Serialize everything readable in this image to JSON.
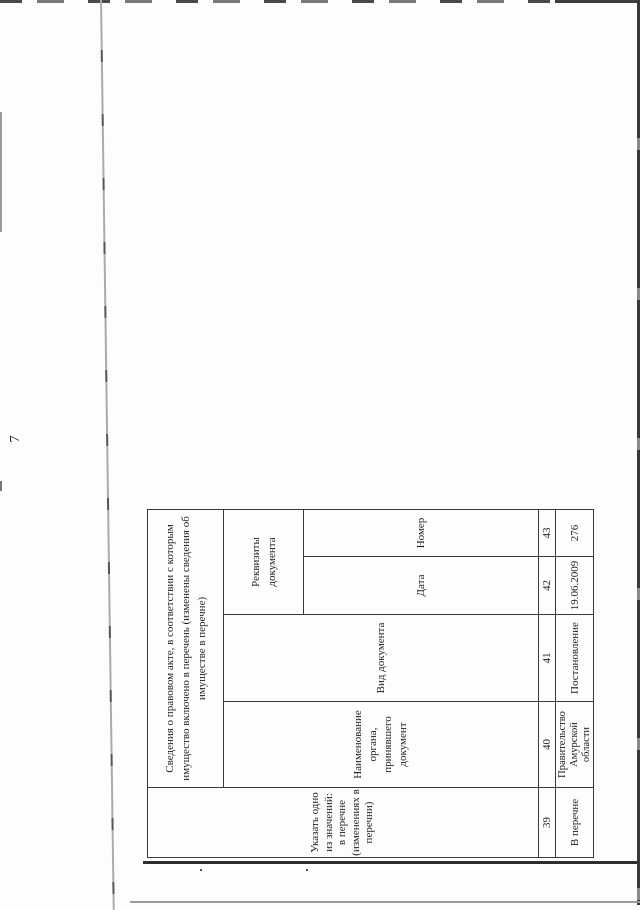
{
  "page": {
    "number": "7"
  },
  "table": {
    "main_header_lines": [
      "Сведения о правовом акте, в соответствии с которым",
      "имущество включено в перечень (изменены сведения об",
      "имуществе в перечне)"
    ],
    "col39_header_lines": [
      "Указать одно",
      "из значений:",
      "в перечне",
      "(изменениях в",
      "перечни)"
    ],
    "col40_header_lines": [
      "Наименование",
      "органа,",
      "принявшего",
      "документ"
    ],
    "col41_header": "Вид документа",
    "requisites_header_lines": [
      "Реквизиты",
      "документа"
    ],
    "col42_header": "Дата",
    "col43_header": "Номер",
    "col_numbers": [
      "39",
      "40",
      "41",
      "42",
      "43"
    ],
    "values": {
      "col39": "В перечне",
      "col40_lines": [
        "Правительство",
        "Амурской",
        "области"
      ],
      "col41": "Постановление",
      "col42": "19.06.2009",
      "col43": "276"
    }
  },
  "colors": {
    "table_border": "#3a3a3a",
    "text": "#1f1f1f",
    "scan_edge_dark": "#3d3d3d",
    "fold_line_gray": "#9a9a9a",
    "background": "#fdfdfd"
  }
}
